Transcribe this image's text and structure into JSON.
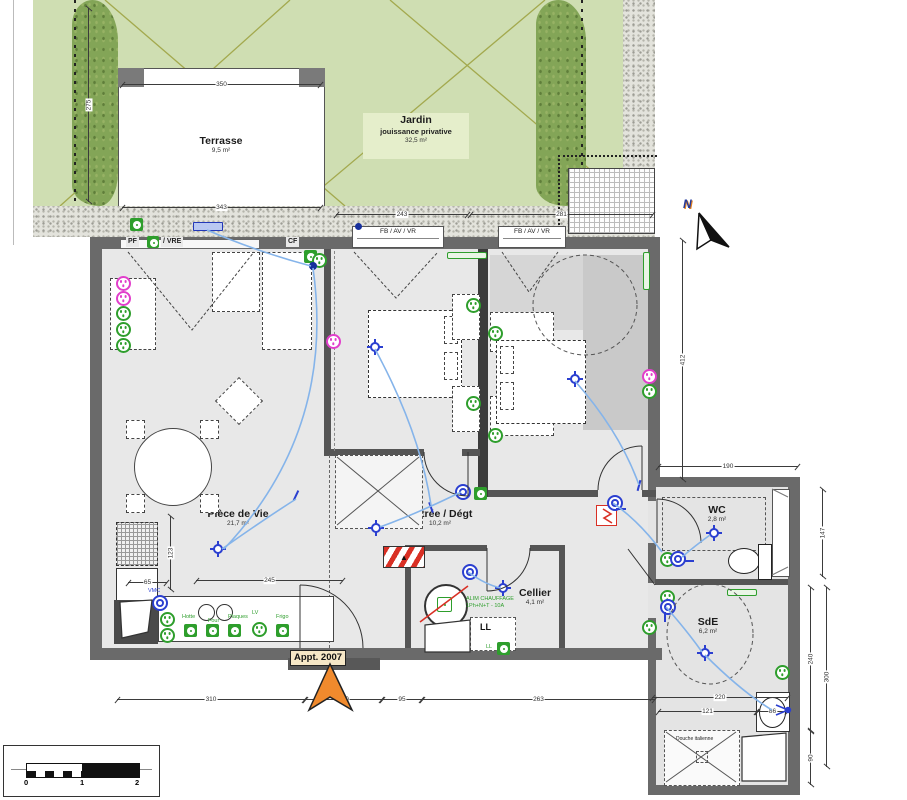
{
  "title": "Plan appartement 2007 - rez-de-jardin",
  "rooms": {
    "terrasse": {
      "name": "Terrasse",
      "area": "9,5 m²"
    },
    "jardin": {
      "name": "Jardin",
      "sub": "jouissance privative",
      "area": "32,5 m²"
    },
    "ch02": {
      "name": "Ch 02",
      "area": "11,0 m²"
    },
    "ch01": {
      "name": "Ch 01",
      "area": "11,6 m²"
    },
    "pdv": {
      "name": "Pièce de Vie",
      "area": "21,7 m²"
    },
    "entree": {
      "name": "Entrée / Dégt",
      "area": "10,2 m²"
    },
    "cellier": {
      "name": "Cellier",
      "area": "4,1 m²"
    },
    "wc": {
      "name": "WC",
      "area": "2,8 m²"
    },
    "sde": {
      "name": "SdE",
      "area": "6,2 m²"
    }
  },
  "labels": {
    "pf": "PF",
    "vre": "/ VRE",
    "cf": "CF",
    "fb": "FB / AV / VR",
    "vmc": "VMC",
    "lv": "LV",
    "ll": "LL",
    "hotte": "Hotte",
    "four": "Four",
    "plaques": "Plaques",
    "frigo": "Frigo",
    "alim1": "ALIM CHAUFFAGE",
    "alim2": "1Ph+N+T - 10A",
    "douche": "Douche italienne",
    "appt": "Appt. 2007",
    "north": "N"
  },
  "dims": {
    "t350": "350",
    "t343": "343",
    "t275": "275",
    "t243": "243",
    "t281": "281",
    "t412": "412",
    "t190": "190",
    "t147": "147",
    "t240": "240",
    "t300": "300",
    "t90": "90",
    "t220": "220",
    "t121": "121",
    "t86": "86",
    "t245": "245",
    "t65": "65",
    "t123": "123",
    "t310": "310",
    "t130": "130",
    "t95": "95",
    "t263": "263"
  },
  "scale": {
    "n0": "0",
    "n1": "1",
    "n2": "2"
  },
  "colors": {
    "garden": "#cfdeb2",
    "hedge": "#83a557",
    "wall": "#6a6a6a",
    "electric_blue": "#2b3fd0",
    "wire_blue": "#85b4ea",
    "outlet_green": "#2e9e2c",
    "socket_magenta": "#e13ecb",
    "alert_red": "#d93025",
    "arrow_orange": "#f08a2d"
  }
}
